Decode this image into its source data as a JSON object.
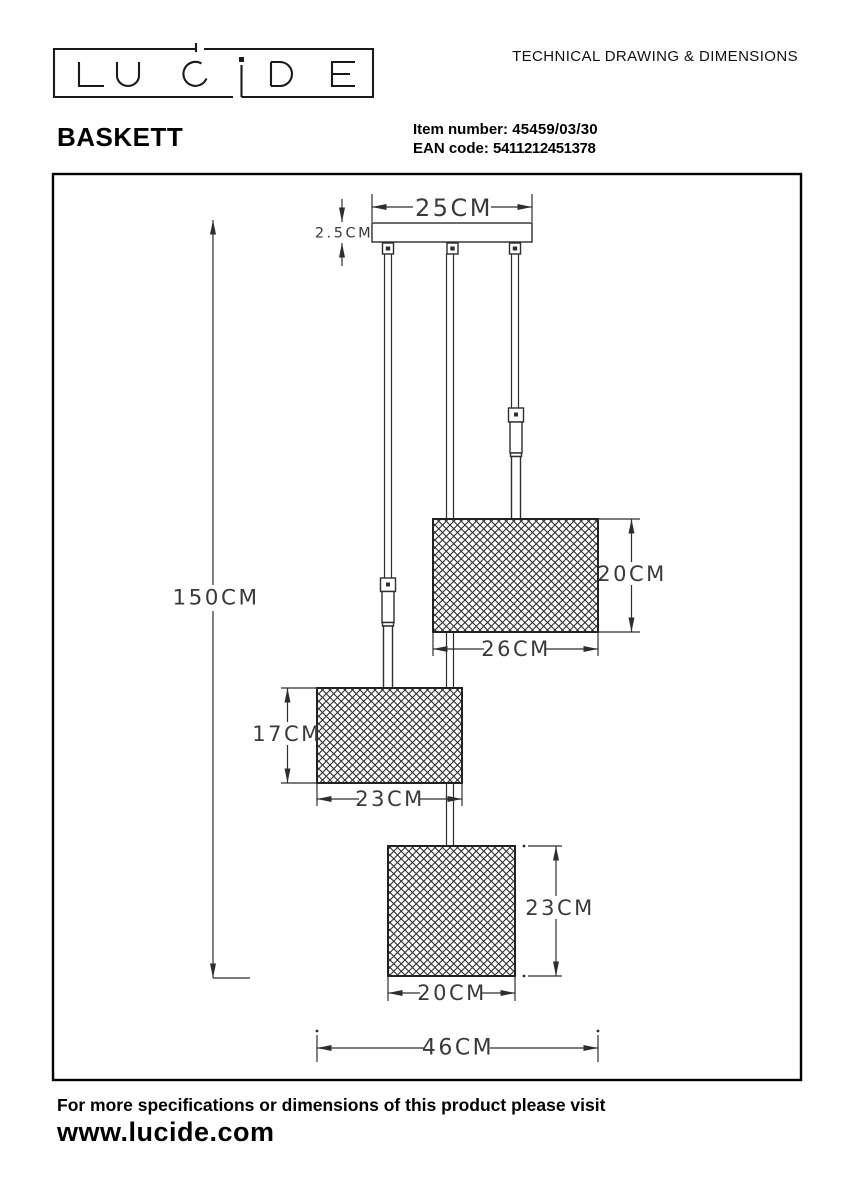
{
  "brand": {
    "name": "LUCIDE"
  },
  "header": {
    "doc_title": "TECHNICAL DRAWING & DIMENSIONS",
    "product_name": "BASKETT",
    "item_number_label": "Item number:",
    "item_number": "45459/03/30",
    "ean_label": "EAN code:",
    "ean_code": "5411212451378"
  },
  "drawing": {
    "dims": {
      "canopy_width": "25CM",
      "canopy_height": "2.5CM",
      "total_height": "150CM",
      "shade_large_height": "20CM",
      "shade_large_width": "26CM",
      "shade_medium_height": "17CM",
      "shade_medium_width": "23CM",
      "shade_small_height": "23CM",
      "shade_small_width": "20CM",
      "total_width": "46CM"
    }
  },
  "footer": {
    "note": "For more specifications or dimensions of this product please visit",
    "website": "www.lucide.com"
  }
}
